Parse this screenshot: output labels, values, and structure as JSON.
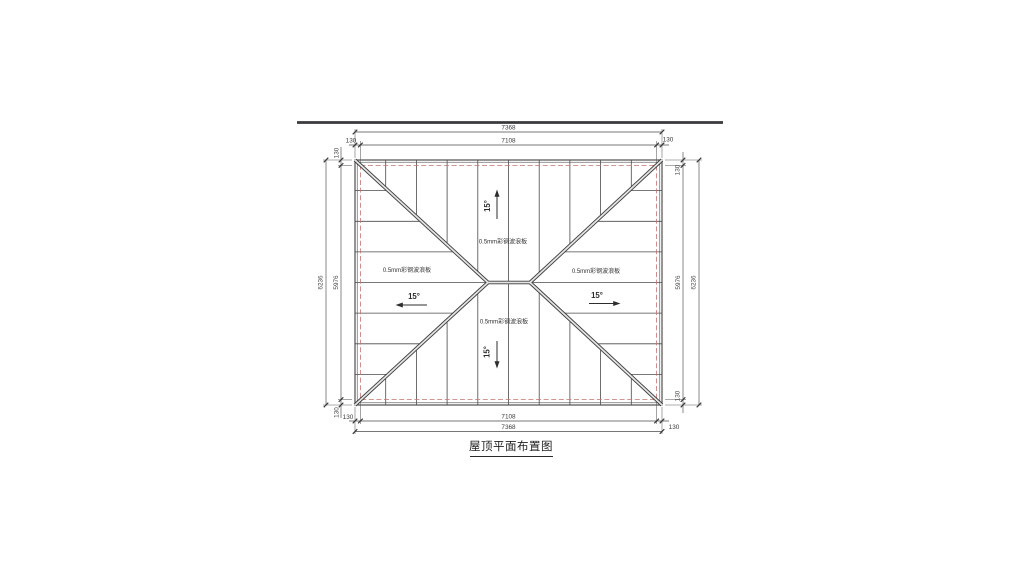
{
  "drawing_title": {
    "text": "屋顶平面布置图"
  },
  "roof": {
    "panel_label": "0.5mm彩钢波浪板",
    "slope_label": "15°",
    "colors": {
      "roof_fill": "#e4e4e4",
      "line": "#3f3f3f",
      "overhang_dashed_line": "#c4736d",
      "background": "#ffffff"
    }
  },
  "dimensions": {
    "overall_width": "7368",
    "inner_width": "7108",
    "overall_depth": "6236",
    "inner_depth": "5976",
    "overhang": "130"
  }
}
